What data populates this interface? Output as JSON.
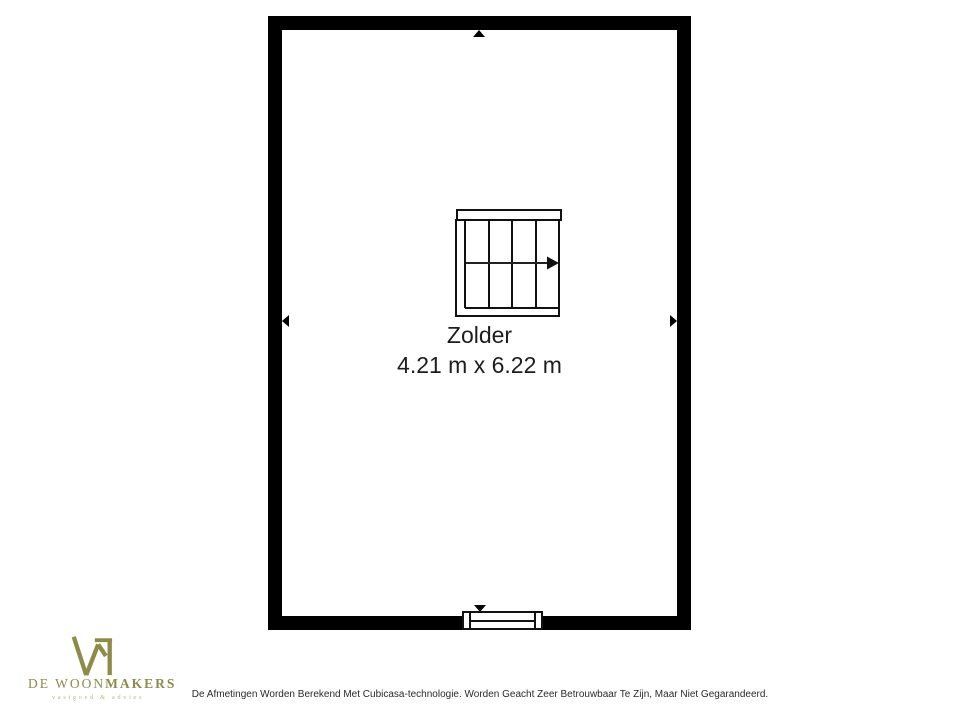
{
  "floorplan": {
    "room": {
      "name": "Zolder",
      "dimensions": "4.21 m x 6.22 m"
    },
    "wall_color": "#000000",
    "symbols": {
      "staircase": "staircase with right direction arrow",
      "window": "window in bottom wall",
      "markers": [
        "up",
        "down",
        "left",
        "right"
      ]
    }
  },
  "branding": {
    "logo_icon": "woonmakers-w-house",
    "name_regular": "DE WOON",
    "name_bold": "MAKERS",
    "tagline": "vastgoed & advies",
    "logo_color": "#8d8b47",
    "tagline_color": "#b9b78f"
  },
  "footer": {
    "disclaimer": "De Afmetingen Worden Berekend Met Cubicasa-technologie. Worden Geacht Zeer Betrouwbaar Te Zijn, Maar Niet Gegarandeerd."
  }
}
